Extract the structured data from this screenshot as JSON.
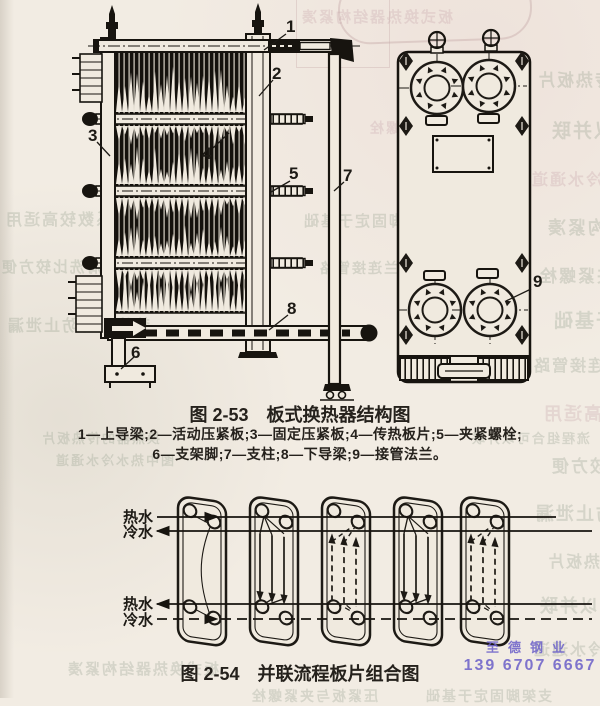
{
  "page": {
    "paper_color": "#f2ece3",
    "ink_color": "#1d1a15"
  },
  "figure_253": {
    "caption_label": "图 2-53",
    "caption_title": "板式换热器结构图",
    "legend_line1": "1—上导梁;2—活动压紧板;3—固定压紧板;4—传热板片;5—夹紧螺栓;",
    "legend_line2": "6—支架脚;7—支柱;8—下导梁;9—接管法兰。",
    "callouts": [
      "1",
      "2",
      "3",
      "4",
      "5",
      "6",
      "7",
      "8",
      "9"
    ]
  },
  "figure_254": {
    "caption_label": "图 2-54",
    "caption_title": "并联流程板片组合图",
    "labels": {
      "hot": "热水",
      "cold": "冷水"
    }
  },
  "watermark": {
    "company": "至德钢业",
    "phone": "139 6707 6667",
    "color": "#6a5fc9"
  },
  "bleedthrough_texts": [
    "换热器的传热板片",
    "流程组合可以并联",
    "图中热水冷水通道",
    "板式换热器结构紧凑",
    "压紧板与夹紧螺栓",
    "支架脚固定于基础",
    "接管法兰连接管路",
    "传热系数较高适用",
    "拆装清洗比较方便",
    "垫片密封防止泄漏"
  ]
}
